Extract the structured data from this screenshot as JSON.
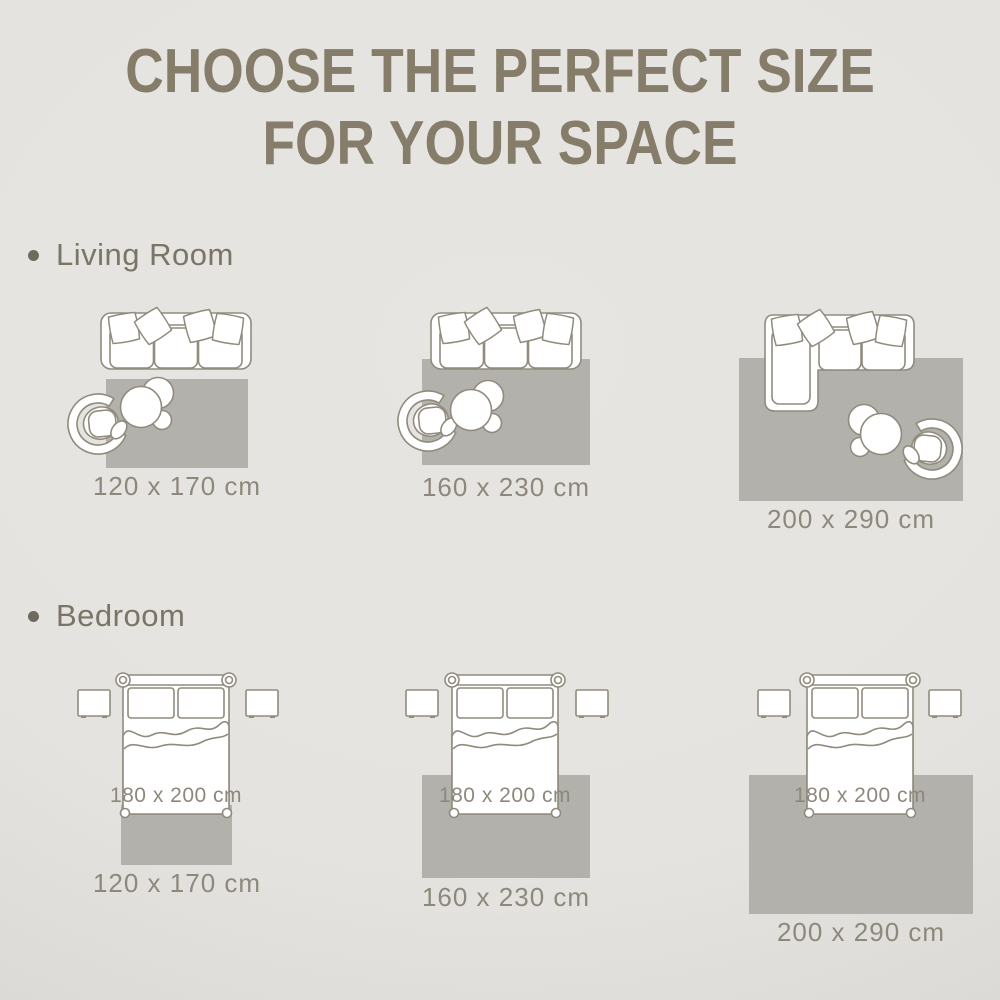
{
  "title": {
    "line1": "CHOOSE THE PERFECT SIZE",
    "line2": "FOR YOUR SPACE"
  },
  "sections": {
    "living_room": {
      "label": "Living Room",
      "scenes": [
        {
          "rug_size": "120 x 170 cm"
        },
        {
          "rug_size": "160 x 230 cm"
        },
        {
          "rug_size": "200 x 290 cm"
        }
      ]
    },
    "bedroom": {
      "label": "Bedroom",
      "scenes": [
        {
          "bed_size": "180 x 200 cm",
          "rug_size": "120 x 170 cm"
        },
        {
          "bed_size": "180 x 200 cm",
          "rug_size": "160 x 230 cm"
        },
        {
          "bed_size": "180 x 200 cm",
          "rug_size": "200 x 290 cm"
        }
      ]
    }
  },
  "colors": {
    "background": "#e5e3df",
    "background_edge": "#d5d3cf",
    "title_text": "#857d6a",
    "section_text": "#7b7567",
    "bullet": "#6f6a5d",
    "illustration_line": "#918b7e",
    "rug_fill": "#b2b1ac",
    "size_label_text": "#8e887c"
  }
}
